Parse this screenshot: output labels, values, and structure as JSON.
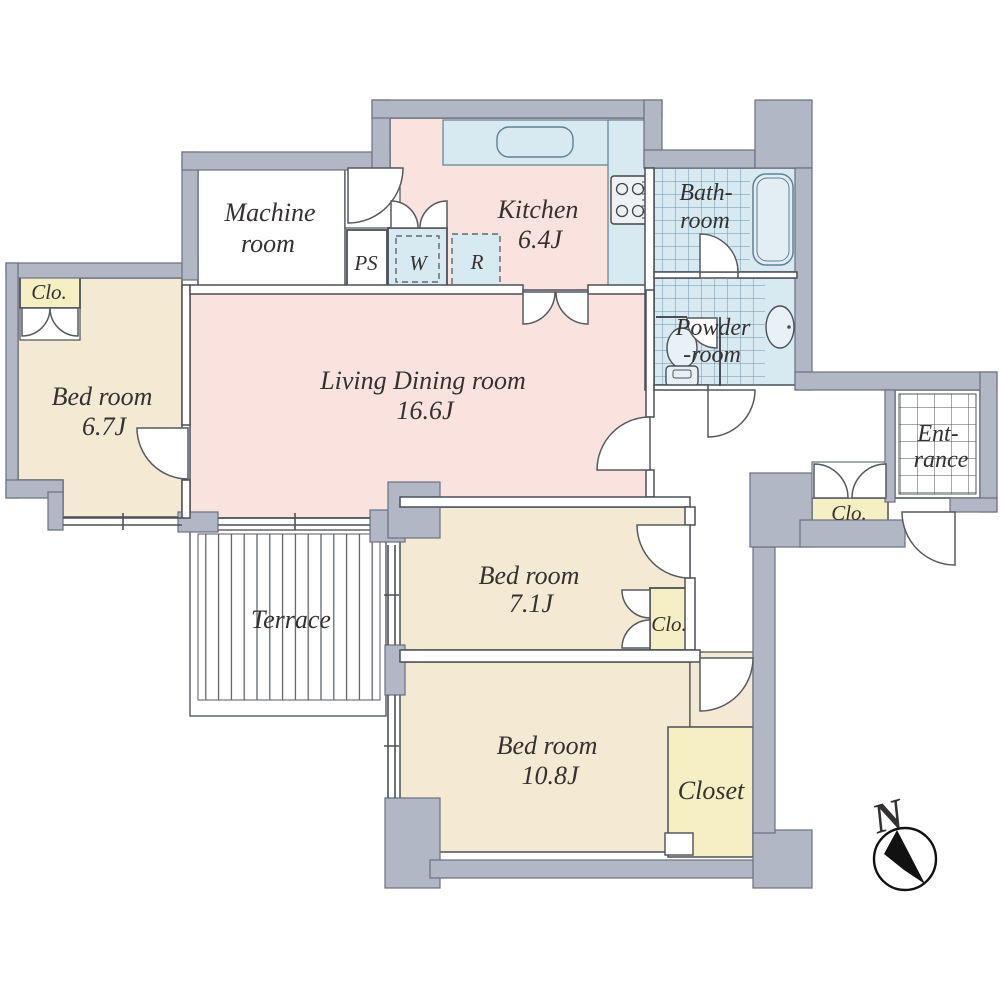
{
  "plan_title": "3LDK apartment floor plan",
  "colors": {
    "wall_fill": "#b2b7c5",
    "wall_edge": "#6a7080",
    "thin_line": "#4b5058",
    "bedroom_beige": "#f4e9d2",
    "living_pink": "#fae3de",
    "closet_yellow": "#f6efc4",
    "wet_area_blue": "#d7e9f1",
    "tile_grid_blue": "#6f93a8"
  },
  "rooms": {
    "machine_room": {
      "line1": "Machine",
      "line2": "room"
    },
    "kitchen": {
      "name": "Kitchen",
      "size": "6.4J"
    },
    "bathroom": {
      "line1": "Bath-",
      "line2": "room"
    },
    "powder_room": {
      "line1": "Powder",
      "line2": "-room"
    },
    "living_dining": {
      "name": "Living Dining room",
      "size": "16.6J"
    },
    "bedroom_67": {
      "name": "Bed room",
      "size": "6.7J"
    },
    "bedroom_71": {
      "name": "Bed room",
      "size": "7.1J"
    },
    "bedroom_108": {
      "name": "Bed room",
      "size": "10.8J"
    },
    "entrance": {
      "line1": "Ent-",
      "line2": "rance"
    },
    "terrace": {
      "name": "Terrace"
    },
    "closet": {
      "name": "Closet"
    },
    "clo_bedroom67": {
      "name": "Clo."
    },
    "clo_bedroom71": {
      "name": "Clo."
    },
    "clo_entrance": {
      "name": "Clo."
    },
    "pipe_space": {
      "name": "PS"
    },
    "washer": {
      "name": "W"
    },
    "refrigerator": {
      "name": "R"
    }
  },
  "fixtures": {
    "bathtub": "bathtub-icon",
    "toilet": "toilet-icon",
    "washbasin": "washbasin-icon",
    "stove": "gas-stove-icon",
    "kitchen_sink": "kitchen-sink-icon"
  },
  "compass": {
    "north_label": "N"
  }
}
